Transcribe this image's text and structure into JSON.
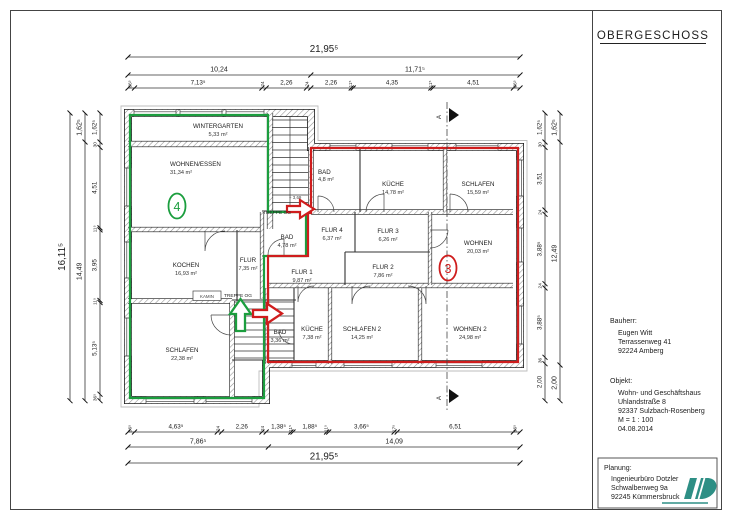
{
  "title": "OBERGESCHOSS",
  "rooms": [
    {
      "name": "WINTERGARTEN",
      "area": "5,33 m²"
    },
    {
      "name": "WOHNEN/ESSEN",
      "area": "31,34 m²"
    },
    {
      "name": "KOCHEN",
      "area": "16,93 m²"
    },
    {
      "name": "FLUR",
      "area": "7,35 m²"
    },
    {
      "name": "BAD",
      "area": "4,78 m²"
    },
    {
      "name": "SCHLAFEN",
      "area": "22,38 m²"
    },
    {
      "name": "BAD",
      "area": "4,8 m²"
    },
    {
      "name": "KÜCHE",
      "area": "14,78 m²"
    },
    {
      "name": "SCHLAFEN",
      "area": "15,59 m²"
    },
    {
      "name": "FLUR 4",
      "area": "6,37 m²"
    },
    {
      "name": "FLUR 3",
      "area": "6,26 m²"
    },
    {
      "name": "WOHNEN",
      "area": "20,03 m²"
    },
    {
      "name": "FLUR 1",
      "area": "9,87 m²"
    },
    {
      "name": "FLUR 2",
      "area": "7,86 m²"
    },
    {
      "name": "BAD",
      "area": "3,36 m²"
    },
    {
      "name": "KÜCHE",
      "area": "7,38 m²"
    },
    {
      "name": "SCHLAFEN 2",
      "area": "14,25 m²"
    },
    {
      "name": "WOHNEN 2",
      "area": "24,98 m²"
    }
  ],
  "stairs": {
    "label": "TREPPE OG",
    "level": "+ 3,69",
    "kamin": "KAMIN"
  },
  "unit_markers": {
    "green": "4",
    "red": "3"
  },
  "section_label": "A",
  "dims": {
    "top": {
      "total": "21,95⁵",
      "mid": [
        "10,24",
        "11,71⁵"
      ],
      "detail": [
        "36⁵",
        "7,13⁵",
        "24",
        "2,26",
        "24",
        "2,26",
        "11⁵",
        "4,35",
        "11⁵",
        "4,51",
        "36⁵"
      ]
    },
    "bottom": {
      "total": "21,95⁵",
      "mid": [
        "7,86⁵",
        "14,09"
      ],
      "detail": [
        "36⁵",
        "4,63⁵",
        "24",
        "2,26",
        "24",
        "1,38⁵",
        "11⁵",
        "1,88⁵",
        "11⁵",
        "3,66⁵",
        "17⁵",
        "6,51",
        "36⁵"
      ]
    },
    "left": {
      "total": "16,11⁵",
      "mid": [
        "1,62⁵",
        "14,49"
      ],
      "detail": [
        "1,62⁵",
        "30",
        "4,51",
        "11⁵",
        "3,95",
        "11⁵",
        "5,13⁵",
        "36⁵"
      ]
    },
    "right": {
      "chain": [
        "1,62⁵",
        "30",
        "3,51",
        "24",
        "3,88⁵",
        "24",
        "3,88⁵",
        "36",
        "2,00"
      ],
      "outer": [
        "1,62⁵",
        "12,49",
        "2,00"
      ]
    }
  },
  "info": {
    "bauherr": {
      "label": "Bauherr:",
      "lines": [
        "Eugen Witt",
        "Terrassenweg 41",
        "92224 Amberg"
      ]
    },
    "objekt": {
      "label": "Objekt:",
      "lines": [
        "Wohn- und Geschäftshaus",
        "Uhlandstraße 8",
        "92337 Sulzbach-Rosenberg",
        "M = 1 : 100",
        "04.08.2014"
      ]
    },
    "planung": {
      "label": "Planung:",
      "lines": [
        "Ingenieurbüro Dotzler",
        "Schwalbenweg 9a",
        "92245 Kümmersbruck"
      ]
    }
  },
  "colors": {
    "apartment_green": "#1b9e3e",
    "apartment_red": "#cf1d1d",
    "logo_teal": "#2e8f85"
  }
}
